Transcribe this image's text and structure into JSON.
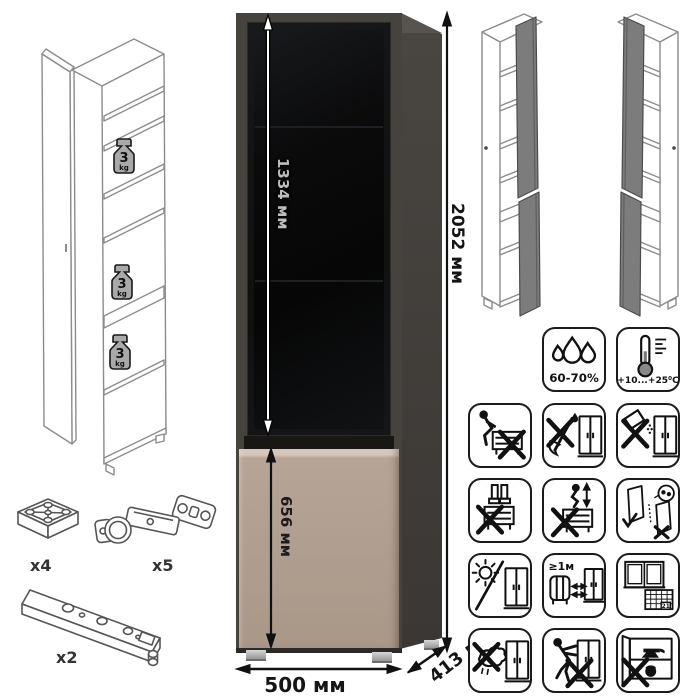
{
  "dimensions": {
    "total_height": "2052 мм",
    "glass_door_height": "1334 мм",
    "bottom_door_height": "656 мм",
    "width": "500 мм",
    "depth": "413 мм"
  },
  "shelf_load": {
    "value": "3",
    "unit": "kg"
  },
  "hardware": {
    "foot_count": "x4",
    "hinge_count": "x5",
    "rail_count": "x2"
  },
  "conditions": {
    "humidity": "60-70%",
    "temperature": "+10...+25⁰C",
    "heater_distance": "≥1м",
    "calendar_day": "21"
  },
  "icons": [
    "humidity-icon",
    "temperature-icon",
    "no-sitting-icon",
    "no-sharp-tools-icon",
    "no-spilling-icon",
    "no-standing-icon",
    "no-jumping-icon",
    "door-adjustment-icon",
    "no-direct-sunlight-icon",
    "heater-distance-icon",
    "ventilation-schedule-icon",
    "no-wet-cleaning-icon",
    "no-pushing-icon",
    "no-heavy-load-icon"
  ],
  "colors": {
    "frame_dark_grey": "#46423e",
    "glass_black": "#0b0b0c",
    "door_beige": "#b3a193",
    "door_highlight": "#d9cdc0",
    "open_door_grey": "#7c7c7c",
    "wireframe_grey": "#8c8c8c"
  }
}
